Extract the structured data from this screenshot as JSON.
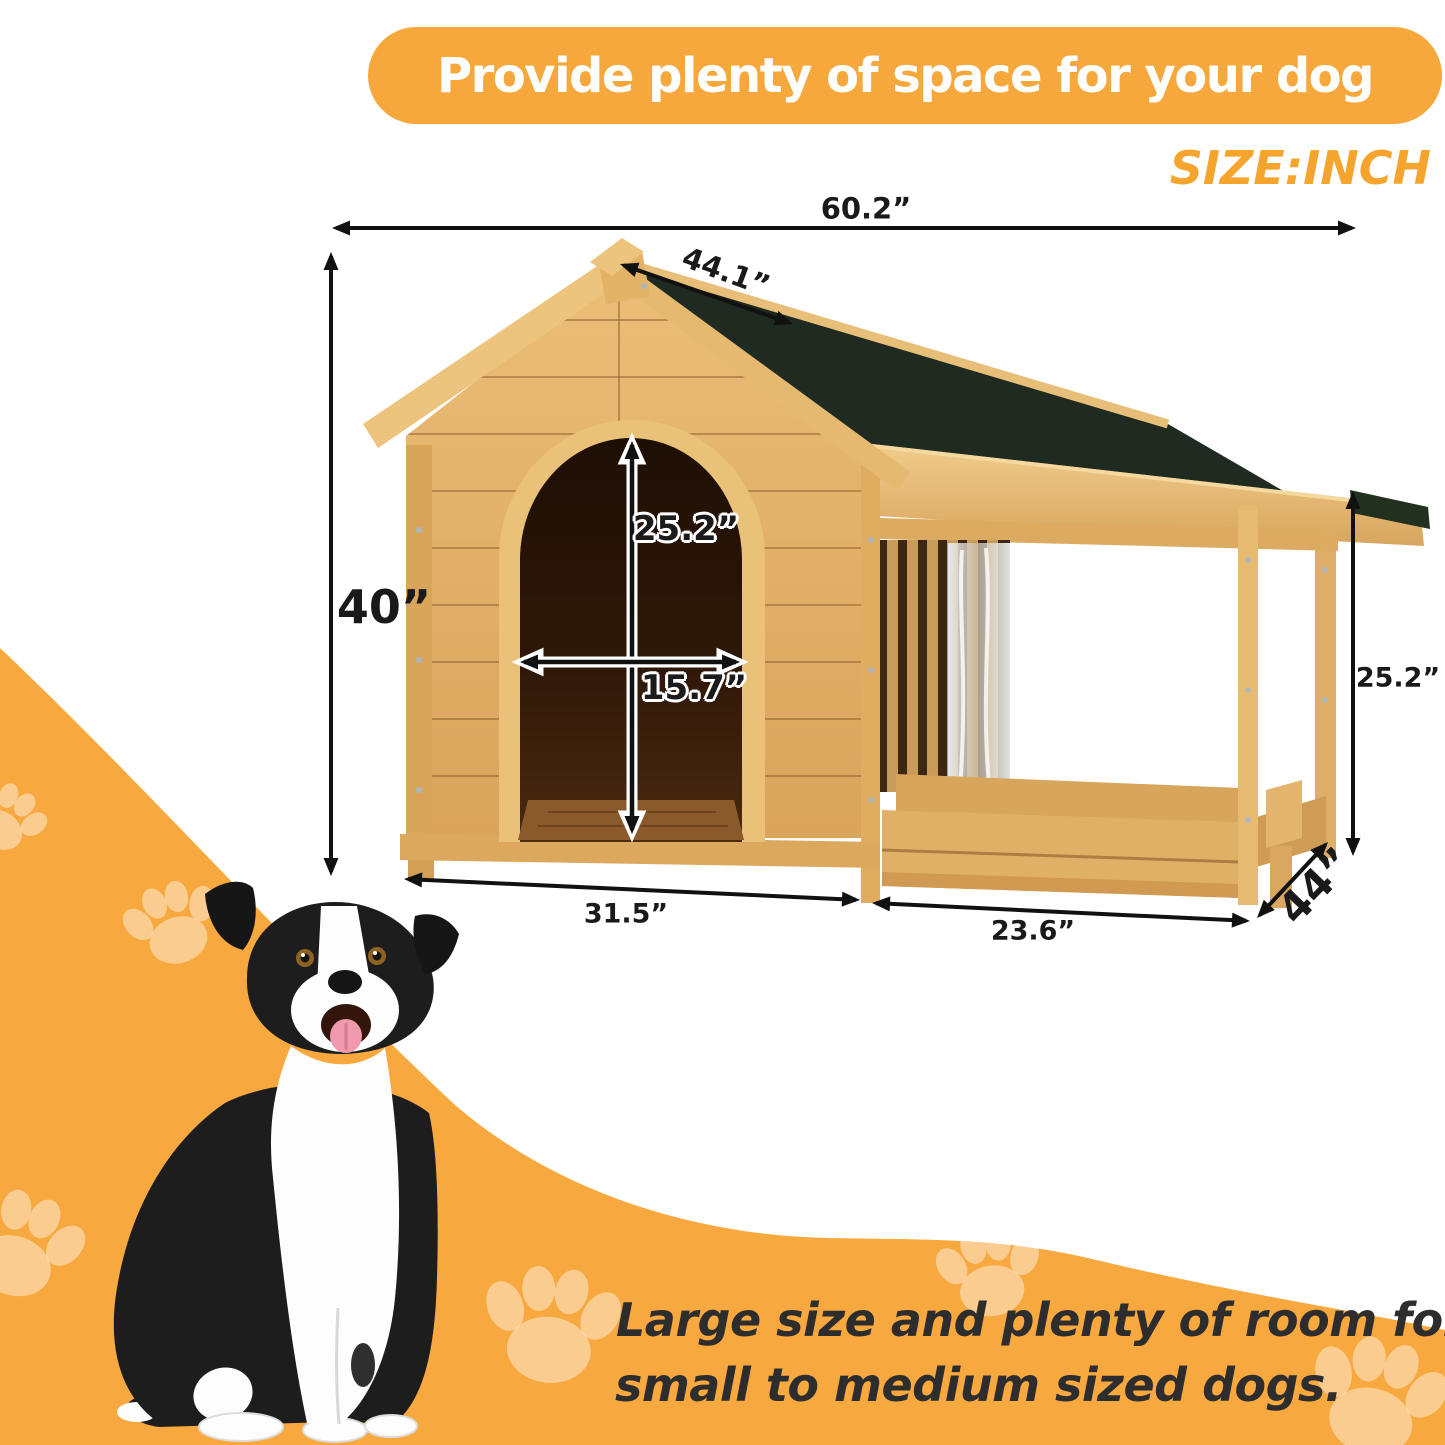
{
  "banner": {
    "title": "Provide plenty of space for your dog",
    "bg_color": "#F6A83C",
    "text_color": "#ffffff"
  },
  "size_unit_label": "SIZE:INCH",
  "size_unit_color": "#F5A52E",
  "dimensions": {
    "overall_width": "60.2”",
    "roof_length": "44.1”",
    "overall_height": "40”",
    "door_height": "25.2”",
    "door_width": "15.7”",
    "porch_height": "25.2”",
    "house_base_width": "31.5”",
    "porch_base_width": "23.6”",
    "overall_depth": "44”"
  },
  "footer": {
    "line1": "Large size and plenty of room for",
    "line2": "small to medium sized dogs."
  },
  "colors": {
    "wave_orange": "#F7A83E",
    "paw_print": "rgba(255,255,255,0.42)",
    "wood_light": "#E3B26C",
    "wood_trim": "#EFC983",
    "roof_shingle": "#1F2A21",
    "door_interior": "#2B1708",
    "dimension_text": "#1a1a1a",
    "footer_text": "#2d2d2d"
  }
}
